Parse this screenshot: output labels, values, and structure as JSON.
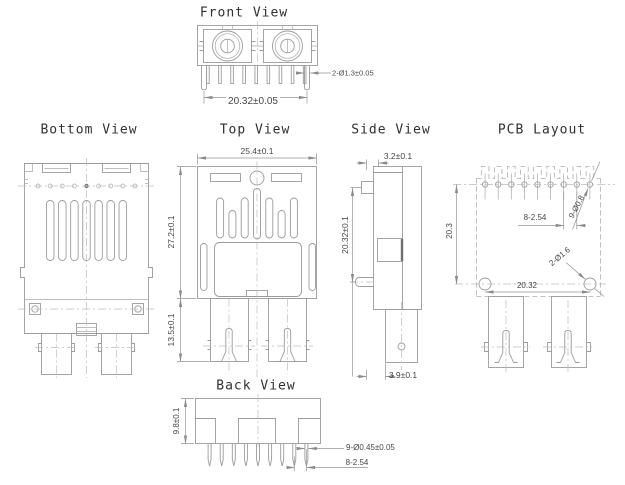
{
  "views": {
    "front": {
      "title": "Front View",
      "dims": {
        "peg_diameter": "2-Ø1.3±0.05",
        "peg_span": "20.32±0.05"
      }
    },
    "bottom": {
      "title": "Bottom View"
    },
    "top": {
      "title": "Top View",
      "dims": {
        "body_width": "25.4±0.1",
        "body_depth": "27.2±0.1",
        "leg_length": "13.5±0.1"
      }
    },
    "side": {
      "title": "Side View",
      "dims": {
        "panel_thickness": "3.2±0.1",
        "pin_span": "20.32±0.1",
        "leg_offset": "3.9±0.1"
      }
    },
    "pcb": {
      "title": "PCB Layout",
      "dims": {
        "pin_pitch": "8-2.54",
        "pin_holes": "9-Ø0.8",
        "peg_holes": "2-Ø1.6",
        "vertical_span": "20.3",
        "horizontal_span": "20.32"
      }
    },
    "back": {
      "title": "Back View",
      "dims": {
        "body_height": "9.8±0.1",
        "pin_diameter": "9-Ø0.45±0.05",
        "pin_pitch": "8-2.54"
      }
    }
  },
  "colors": {
    "line": "#9c9c9c",
    "dim": "#949494",
    "centerline": "#bcbcbc",
    "text": "#474747",
    "title": "#303030",
    "background": "#ffffff"
  }
}
